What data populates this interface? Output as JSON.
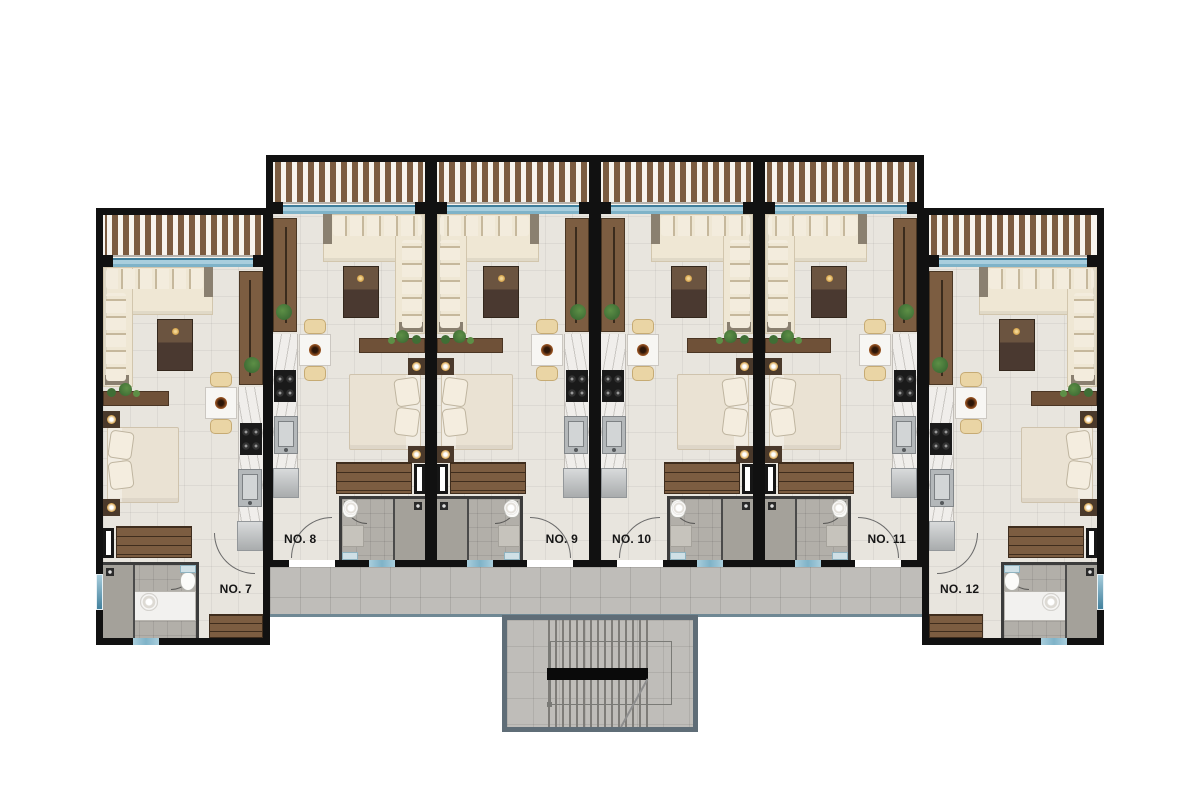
{
  "page": {
    "background": "#ffffff",
    "description": "Upper-floor architectural plan with six studio apartments, central corridor and stairwell"
  },
  "units": [
    {
      "id": "no-7",
      "label": "NO. 7",
      "x": 96,
      "y": 208,
      "w": 174,
      "h": 437,
      "mirrored": true,
      "end": true,
      "label_side": "right"
    },
    {
      "id": "no-8",
      "label": "NO. 8",
      "x": 266,
      "y": 155,
      "w": 166,
      "h": 412,
      "mirrored": false,
      "end": false,
      "label_side": "left"
    },
    {
      "id": "no-9",
      "label": "NO. 9",
      "x": 430,
      "y": 155,
      "w": 166,
      "h": 412,
      "mirrored": true,
      "end": false,
      "label_side": "right"
    },
    {
      "id": "no-10",
      "label": "NO. 10",
      "x": 594,
      "y": 155,
      "w": 166,
      "h": 412,
      "mirrored": false,
      "end": false,
      "label_side": "left"
    },
    {
      "id": "no-11",
      "label": "NO. 11",
      "x": 758,
      "y": 155,
      "w": 166,
      "h": 412,
      "mirrored": true,
      "end": false,
      "label_side": "right"
    },
    {
      "id": "no-12",
      "label": "NO. 12",
      "x": 922,
      "y": 208,
      "w": 182,
      "h": 437,
      "mirrored": false,
      "end": true,
      "label_side": "left"
    }
  ],
  "corridor": {
    "x": 270,
    "y": 567,
    "w": 652,
    "h": 50
  },
  "stairwell": {
    "x": 502,
    "y": 615,
    "w": 196,
    "h": 117
  },
  "colors": {
    "wall": "#111111",
    "floor": "#e8e5de",
    "balcony_bg": "#f7f4ee",
    "slat_wood": "#7b5c41",
    "glass_dark": "#3f7e9b",
    "glass_light": "#a9cedd",
    "window_teal": "#7fb3c8",
    "sofa_body": "#efe7d4",
    "sofa_pillow": "#f3ecdd",
    "sofa_shadow": "#c6b89c",
    "sofa_frame": "#8a8070",
    "wood_light": "#7c5d41",
    "wood_mid": "#6f5138",
    "tv_gold": "#cf9c43",
    "plant": "#3f6e35",
    "plant_light": "#5d8f46",
    "marble": "#f0eeeb",
    "marble_vein": "#c9c6c2",
    "appliance_dark": "#1a1a1a",
    "steel": "#b4b8ba",
    "steel_light": "#d2d5d6",
    "bed": "#eae2d3",
    "bath_tile": "#b2afa9",
    "shower": "#a4a19a",
    "fixture_white": "#fbfbf9",
    "corridor_tile": "#bfbdb9",
    "corridor_edge": "#6f8894",
    "stair_wall": "#5f6d77",
    "tread": "#7e7c78",
    "rail_black": "#0a0a0a"
  }
}
